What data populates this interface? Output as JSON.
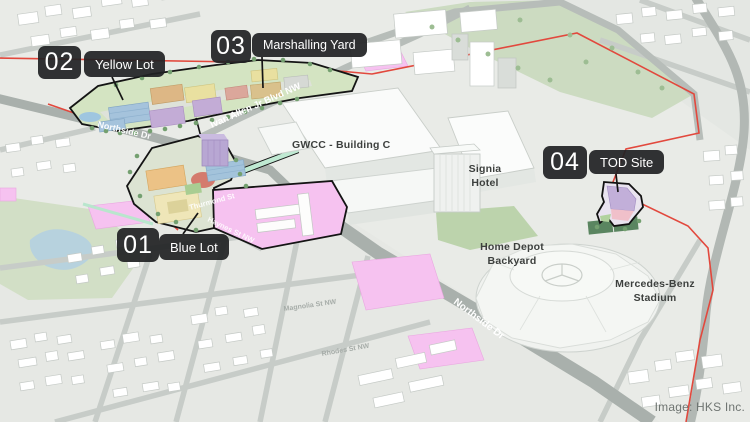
{
  "callouts": [
    {
      "number": "01",
      "label": "Blue Lot"
    },
    {
      "number": "02",
      "label": "Yellow Lot"
    },
    {
      "number": "03",
      "label": "Marshalling Yard"
    },
    {
      "number": "04",
      "label": "TOD Site"
    }
  ],
  "map_labels": {
    "gwcc": "GWCC - Building C",
    "signia_line1": "Signia",
    "signia_line2": "Hotel",
    "home_depot_line1": "Home Depot",
    "home_depot_line2": "Backyard",
    "stadium_line1": "Mercedes-Benz",
    "stadium_line2": "Stadium"
  },
  "street_labels": {
    "northside_top": "Northside Dr",
    "ivan_allen": "Ivan Allen Jr Blvd NW",
    "thurmond": "Thurmond St",
    "haynes": "Haynes St NW",
    "magnolia": "Magnolia St NW",
    "rhodes": "Rhodes St NW",
    "northside_bottom": "Northside Dr"
  },
  "attribution": "Image: HKS Inc.",
  "colors": {
    "callout_bg": "#212225",
    "callout_text": "#ffffff",
    "route_red": "#e2483d",
    "parcel_pink": "#f6c2f0",
    "site_outline": "#141414",
    "map_background": "#e9ebe7"
  }
}
